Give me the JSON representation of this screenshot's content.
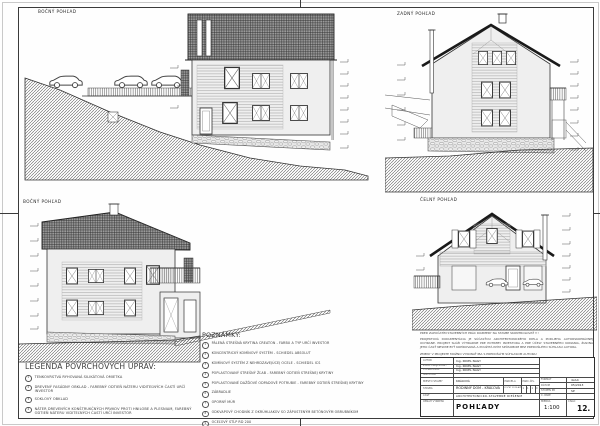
{
  "labels": {
    "view_top_left": "BOČNÝ POHĽAD",
    "view_top_right": "ZADNÝ POHĽAD",
    "view_bottom_left": "BOČNÝ POHĽAD",
    "view_bottom_right": "ČELNÝ POHĽAD"
  },
  "legend": {
    "title": "LEGENDA POVRCHOVÝCH ÚPRAV:",
    "items": [
      {
        "num": "1",
        "text": "TENKOVRSTVÁ RYHOVANÁ SILIKÁTOVÁ OMIETKA"
      },
      {
        "num": "2",
        "text": "DREVENÝ FASÁDNY OBKLAD - FAREBNÝ ODTIEŇ NÁTERU VIDITEĽNÝCH ČASTÍ URČÍ INVESTOR"
      },
      {
        "num": "3",
        "text": "SOKLOVÝ OBKLAD"
      },
      {
        "num": "4",
        "text": "NÁTER DREVENÝCH KONŠTRUKČNÝCH PRVKOV PROTI HNILOBE A PLESNIAM, FAREBNÝ ODTIEŇ NÁTERU VIDITEĽNÝCH ČASTÍ URČÍ INVESTOR"
      }
    ]
  },
  "notes": {
    "title": "POZNÁMKY:",
    "items": [
      {
        "num": "1",
        "text": "PÁLENÁ STREŠNÁ KRYTINA CREATON - FARBU A TYP URČÍ INVESTOR"
      },
      {
        "num": "2",
        "text": "KONCENTRICKÝ KOMÍNOVÝ SYSTÉM - SCHIEDEL ABSOLUT"
      },
      {
        "num": "3",
        "text": "KOMÍNOVÝ SYSTÉM Z NEHRDZAVEJÚCEJ OCELE - SCHIEDEL ICS"
      },
      {
        "num": "4",
        "text": "POPLASTOVANÝ STREŠNÝ ŽĽAB - FAREBNÝ ODTIEŇ STREŠNEJ KRYTINY"
      },
      {
        "num": "5",
        "text": "POPLASTOVANÉ DAŽĎOVÉ ODPADOVÉ POTRUBIE - FAREBNÝ ODTIEŇ STREŠNEJ KRYTINY"
      },
      {
        "num": "6",
        "text": "ZÁBRADLIE"
      },
      {
        "num": "7",
        "text": "OPORNÝ MÚR"
      },
      {
        "num": "8",
        "text": "ODKVAPOVÝ CHODNÍK Z OKRÚHLIAKOV SO ZÁPUSTENÝM BETÓNOVÝM OBRUBNÍKOM"
      },
      {
        "num": "9",
        "text": "OCEĽOVÝ STĹP RD 200"
      }
    ]
  },
  "disclaimer": {
    "warning": "PRED ZAPOČATÍM STAVEBNÝCH PRÁC ROZMERY NA STAVBE SKONTROLOVAŤ !!!",
    "body": "PROJEKTOVÁ DOKUMENTÁCIA JE SÚČASŤOU ARCHITEKTONICKÉHO DIELA A PODLIEHA AUTORSKOPRÁVNEJ OCHRANE. PROJEKT SLÚŽI VÝHRADNE PRE POTREBY INVESTORA A PRE ÚČELY STAVEBNÉHO KONANIA, ŽIADNA JEHO ČASŤ NESMIE BYŤ KOPÍROVANÁ A POUŽITÁ INÝM SPÔSOBOM BEZ PREDOŠLÉHO SÚHLASU AUTORA.",
    "changes": "ZMENY V PROJEKTE MOŽNO VYKONAŤ IBA S PREDOŠLÝM SÚHLASOM AUTORA!"
  },
  "title_block": {
    "author_label": "AUTOR",
    "author": "Ing. PAVEL NAGY",
    "resp_label": "ZODP. PROJEKTANT",
    "resp": "Ing. PAVEL NAGY",
    "drawn_label": "VYPRACOVAL",
    "drawn": "Ing. PAVEL NAGY",
    "investor_label": "INVESTOR",
    "investor": "",
    "place_label": "MIESTO STAVBY",
    "place": "KRÁĽOVÁ",
    "parcel_label": "PARCELA",
    "parcel_value": "PARC.ČÍS.",
    "building_label": "STAVBA",
    "building": "RODINNÝ DOM - KRÁĽOVÁ",
    "floors_label": "POČET PODLAŽÍ",
    "floors": [
      "1",
      "1",
      "1",
      "0"
    ],
    "part_label": "ČASŤ",
    "part": "ARCHITEKTONICKO-STAVEBNÉ RIEŠENIE",
    "content_label": "OBSAH VÝKRESU",
    "content": "POHĽADY",
    "format_label": "FORMÁT",
    "format": "4xA4",
    "date_label": "DÁTUM",
    "date": "05/2013",
    "stage_label": "STUPEŇ PD",
    "stage": "SP",
    "copy_label": "Č. PARÉ",
    "copy": "",
    "scale_label": "MIERKA",
    "scale": "1:100",
    "number_label": "ČÍSLO",
    "number": "12."
  }
}
